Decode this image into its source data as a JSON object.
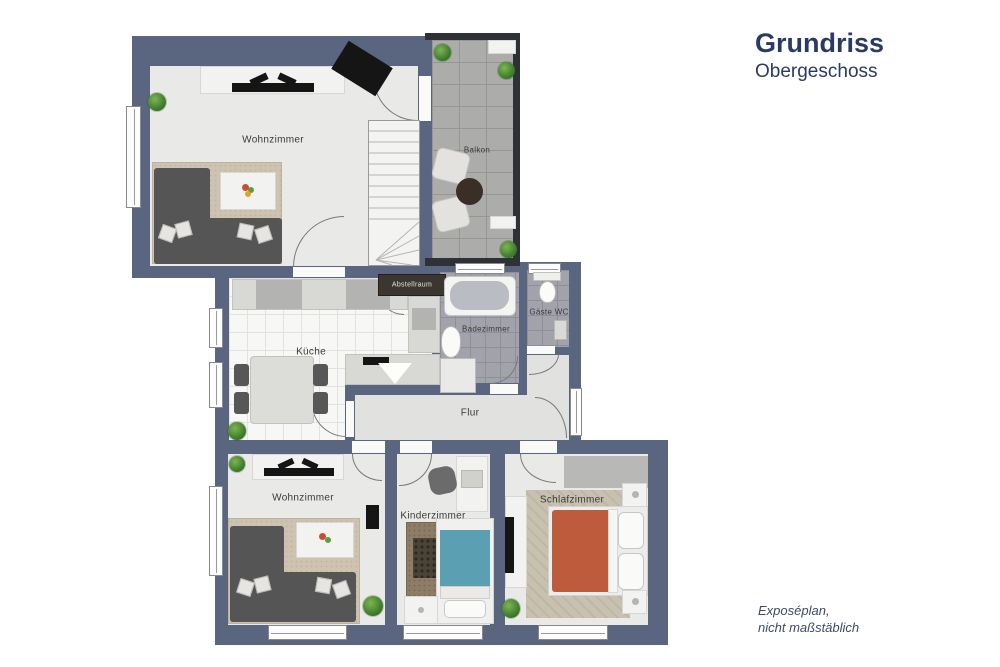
{
  "header": {
    "title": "Grundriss",
    "subtitle": "Obergeschoss"
  },
  "footer": {
    "line1": "Exposéplan,",
    "line2": "nicht maßstäblich"
  },
  "rooms": {
    "wohnzimmer_top": {
      "label": "Wohnzimmer"
    },
    "balkon": {
      "label": "Balkon"
    },
    "kueche": {
      "label": "Küche"
    },
    "abstellraum": {
      "label": "Abstellraum"
    },
    "badezimmer": {
      "label": "Badezimmer"
    },
    "gaeste_wc": {
      "label": "Gäste WC"
    },
    "flur": {
      "label": "Flur"
    },
    "wohnzimmer_bottom": {
      "label": "Wohnzimmer"
    },
    "kinderzimmer": {
      "label": "Kinderzimmer"
    },
    "schlafzimmer": {
      "label": "Schlafzimmer"
    }
  },
  "colors": {
    "wall": "#5a6580",
    "balcony_wall": "#2e3136",
    "title_text": "#2b3a64",
    "room_floor": "#e9e9e7",
    "bath_tile": "#a2a2aa",
    "bed_blanket": "#bf5b3d",
    "kid_bed_blanket": "#5b9fb2",
    "rug": "#cdc3b0",
    "plant_green": "#3f7d2c"
  }
}
